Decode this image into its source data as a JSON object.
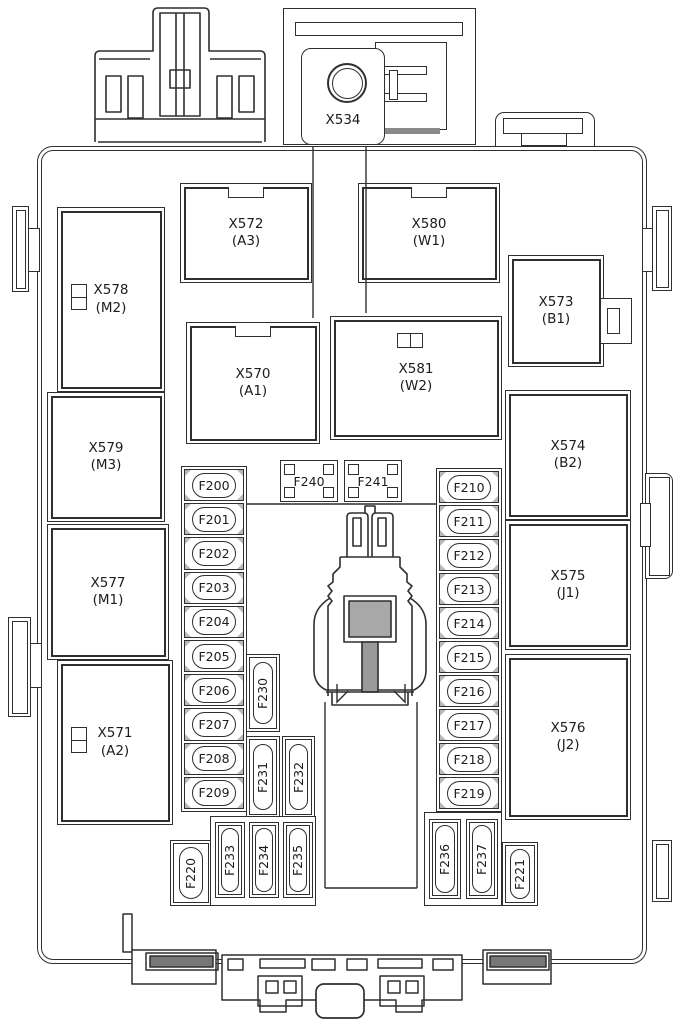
{
  "meta": {
    "kind": "engine-compartment-fuse-box-diagram"
  },
  "palette": {
    "line": "#2f2f2f",
    "text": "#1c1c1c",
    "bg": "#ffffff",
    "shade": "#8a8a8a"
  },
  "top_assembly": {
    "x534": "X534"
  },
  "connector_blocks": [
    {
      "code": "X572",
      "sub": "(A3)"
    },
    {
      "code": "X580",
      "sub": "(W1)"
    },
    {
      "code": "X578",
      "sub": "(M2)"
    },
    {
      "code": "X573",
      "sub": "(B1)"
    },
    {
      "code": "X570",
      "sub": "(A1)"
    },
    {
      "code": "X581",
      "sub": "(W2)"
    },
    {
      "code": "X579",
      "sub": "(M3)"
    },
    {
      "code": "X574",
      "sub": "(B2)"
    },
    {
      "code": "X577",
      "sub": "(M1)"
    },
    {
      "code": "X575",
      "sub": "(J1)"
    },
    {
      "code": "X571",
      "sub": "(A2)"
    },
    {
      "code": "X576",
      "sub": "(J2)"
    }
  ],
  "relay_slots": [
    "F240",
    "F241"
  ],
  "fuse_column_left": [
    "F200",
    "F201",
    "F202",
    "F203",
    "F204",
    "F205",
    "F206",
    "F207",
    "F208",
    "F209"
  ],
  "fuse_column_right": [
    "F210",
    "F211",
    "F212",
    "F213",
    "F214",
    "F215",
    "F216",
    "F217",
    "F218",
    "F219"
  ],
  "mid_vertical_fuses": [
    "F230",
    "F231",
    "F232"
  ],
  "bottom_left_group": {
    "small": "F220",
    "fuses": [
      "F233",
      "F234",
      "F235"
    ]
  },
  "bottom_right_group": {
    "fuses": [
      "F236",
      "F237"
    ],
    "small": "F221"
  }
}
